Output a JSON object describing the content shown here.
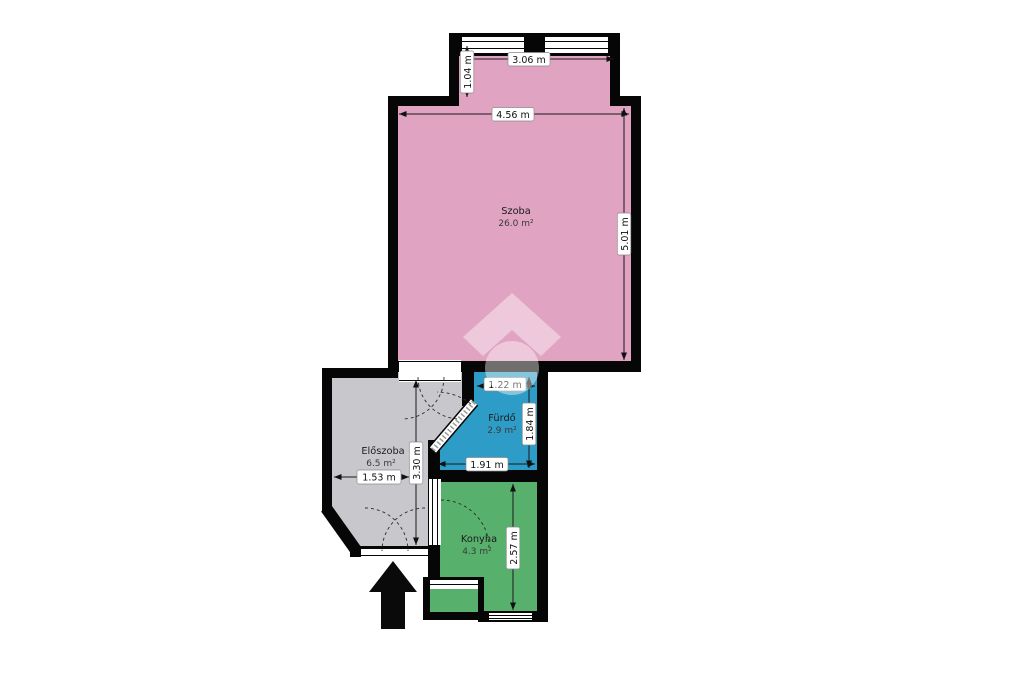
{
  "floorplan": {
    "rooms": {
      "szoba": {
        "name": "Szoba",
        "area": "26.0 m²"
      },
      "eloszoba": {
        "name": "Előszoba",
        "area": "6.5 m²"
      },
      "furdo": {
        "name": "Fürdő",
        "area": "2.9 m²"
      },
      "konyha": {
        "name": "Konyha",
        "area": "4.3 m²"
      }
    },
    "dimensions": {
      "top_width": "3.06 m",
      "upper_height": "1.04 m",
      "szoba_width": "4.56 m",
      "szoba_height": "5.01 m",
      "furdo_top": "1.22 m",
      "furdo_height": "1.84 m",
      "furdo_width": "1.91 m",
      "eloszoba_height": "3.30 m",
      "eloszoba_width": "1.53 m",
      "konyha_height": "2.57 m"
    },
    "colors": {
      "szoba": "#e0a3c1",
      "eloszoba": "#c8c8cc",
      "furdo": "#2d9cc6",
      "konyha": "#58b06d",
      "wall": "#060606",
      "background": "#ffffff"
    }
  }
}
